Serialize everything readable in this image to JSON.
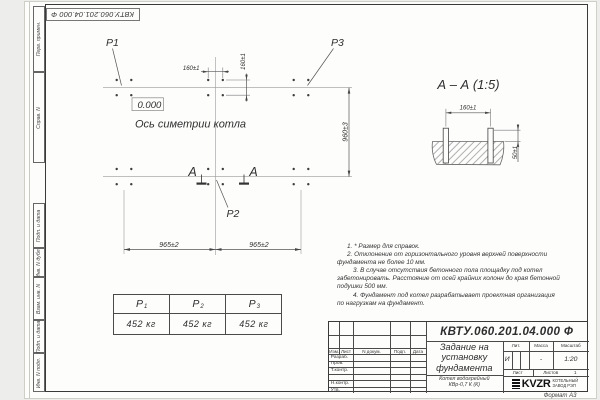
{
  "sheet": {
    "stamp_top": "КВТУ.060.201.04.000 Ф",
    "format_label": "Формат А3",
    "sidebar": [
      "Перв. примен.",
      "Справ. N",
      "Подп. и дата",
      "Инв. N дубл.",
      "Взам. инв. N",
      "Подп. и дата",
      "Инв. N подл."
    ]
  },
  "plan": {
    "load_labels": {
      "p1": "Р1",
      "p2": "Р2",
      "p3": "Р3"
    },
    "elevation": "0.000",
    "axis_label": "Ось симетрии котла",
    "dim_bolt_x": "160±1",
    "dim_bolt_y": "160±1",
    "dim_width": "960±3",
    "dim_span_left": "965±2",
    "dim_span_right": "965±2",
    "section_letter": "А"
  },
  "section_view": {
    "title": "А – А (1:5)",
    "dim_spacing": "160±1",
    "dim_height": "50±1"
  },
  "notes": [
    "1. * Размер для справок.",
    "2. Отклонение от горизонтального уровня верхней поверхности",
    "фундамента не более 10 мм.",
    "3. В случае отсутствия бетонного пола площадку под котел",
    "забетонировать. Расстояние от осей крайних колонн до края бетонной",
    "подушки 500 мм.",
    "4. Фундамент под котел разрабатывает проектная организация",
    "по нагрузкам на фундамент."
  ],
  "load_table": {
    "columns": [
      {
        "head": "Р",
        "sub": "1",
        "value": "452 кг"
      },
      {
        "head": "Р",
        "sub": "2",
        "value": "452 кг"
      },
      {
        "head": "Р",
        "sub": "3",
        "value": "452 кг"
      }
    ]
  },
  "title_block": {
    "doc_number": "КВТУ.060.201.04.000  Ф",
    "title_line1": "Задание на",
    "title_line2": "установку",
    "title_line3": "фундамента",
    "subtitle_line1": "Котел водогрейный",
    "subtitle_line2": "КВр-0,7 К (К)",
    "col_izm": "Изм.",
    "col_list": "Лист",
    "col_doc": "N докум.",
    "col_podp": "Подп.",
    "col_data": "Дата",
    "rows": [
      "Разраб.",
      "Пров.",
      "Т.контр.",
      "",
      "Н.контр.",
      "Утв."
    ],
    "lit_label": "Лит.",
    "mass_label": "Масса",
    "scale_label": "Масштаб",
    "lit_value": "И",
    "mass_value": "-",
    "scale_value": "1:20",
    "sheet_label": "Лист",
    "sheets_label": "Листов",
    "sheets_value": "1",
    "logo_text": "KVZR",
    "org_line1": "КОТЕЛЬНЫЙ",
    "org_line2": "ЗАВОД РЭП"
  }
}
